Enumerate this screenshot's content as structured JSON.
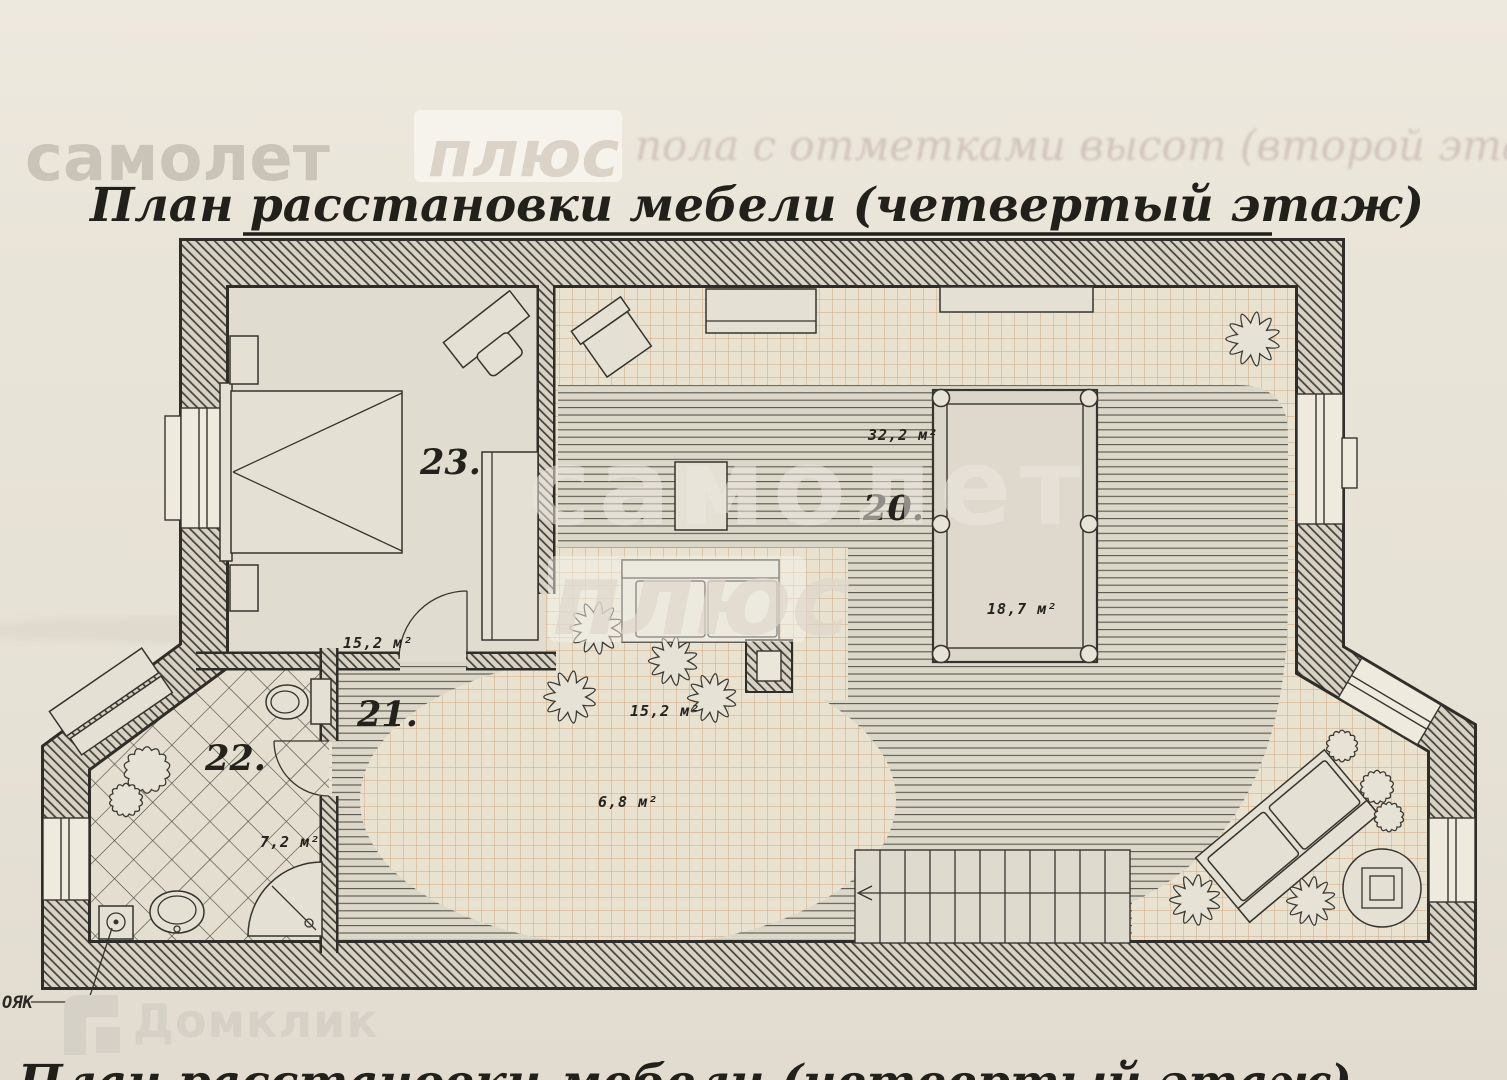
{
  "document": {
    "title": "План расстановки мебели (четвертый  этаж)",
    "next_page_title_partial": "План расстановки мебели (четвертый  этаж)",
    "riser_label": "ОЯК"
  },
  "watermarks": {
    "brand_top": "самолет",
    "brand_top_suffix": "плюс",
    "showthrough_text": "пола с отметками высот (второй  эта",
    "brand_center": "самолет",
    "brand_center_suffix": "плюс",
    "brand_bottom": "Домклик"
  },
  "rooms": {
    "bedroom": {
      "number": "23.",
      "area": "15,2 м²"
    },
    "living": {
      "number": "20.",
      "area_main": "32,2 м²",
      "area_billiard": "18,7 м²"
    },
    "hall": {
      "number": "21.",
      "area_lounge": "15,2 м²",
      "area_center": "6,8 м²"
    },
    "bathroom": {
      "number": "22.",
      "area": "7,2 м²"
    }
  },
  "colors": {
    "paper": "#e8e3d7",
    "ink": "#34332d",
    "wall_hatch_line": "#403f38",
    "tile_line": "#c9966a",
    "wood_line": "#59574d",
    "watermark_gray": "#cdc8bc"
  }
}
